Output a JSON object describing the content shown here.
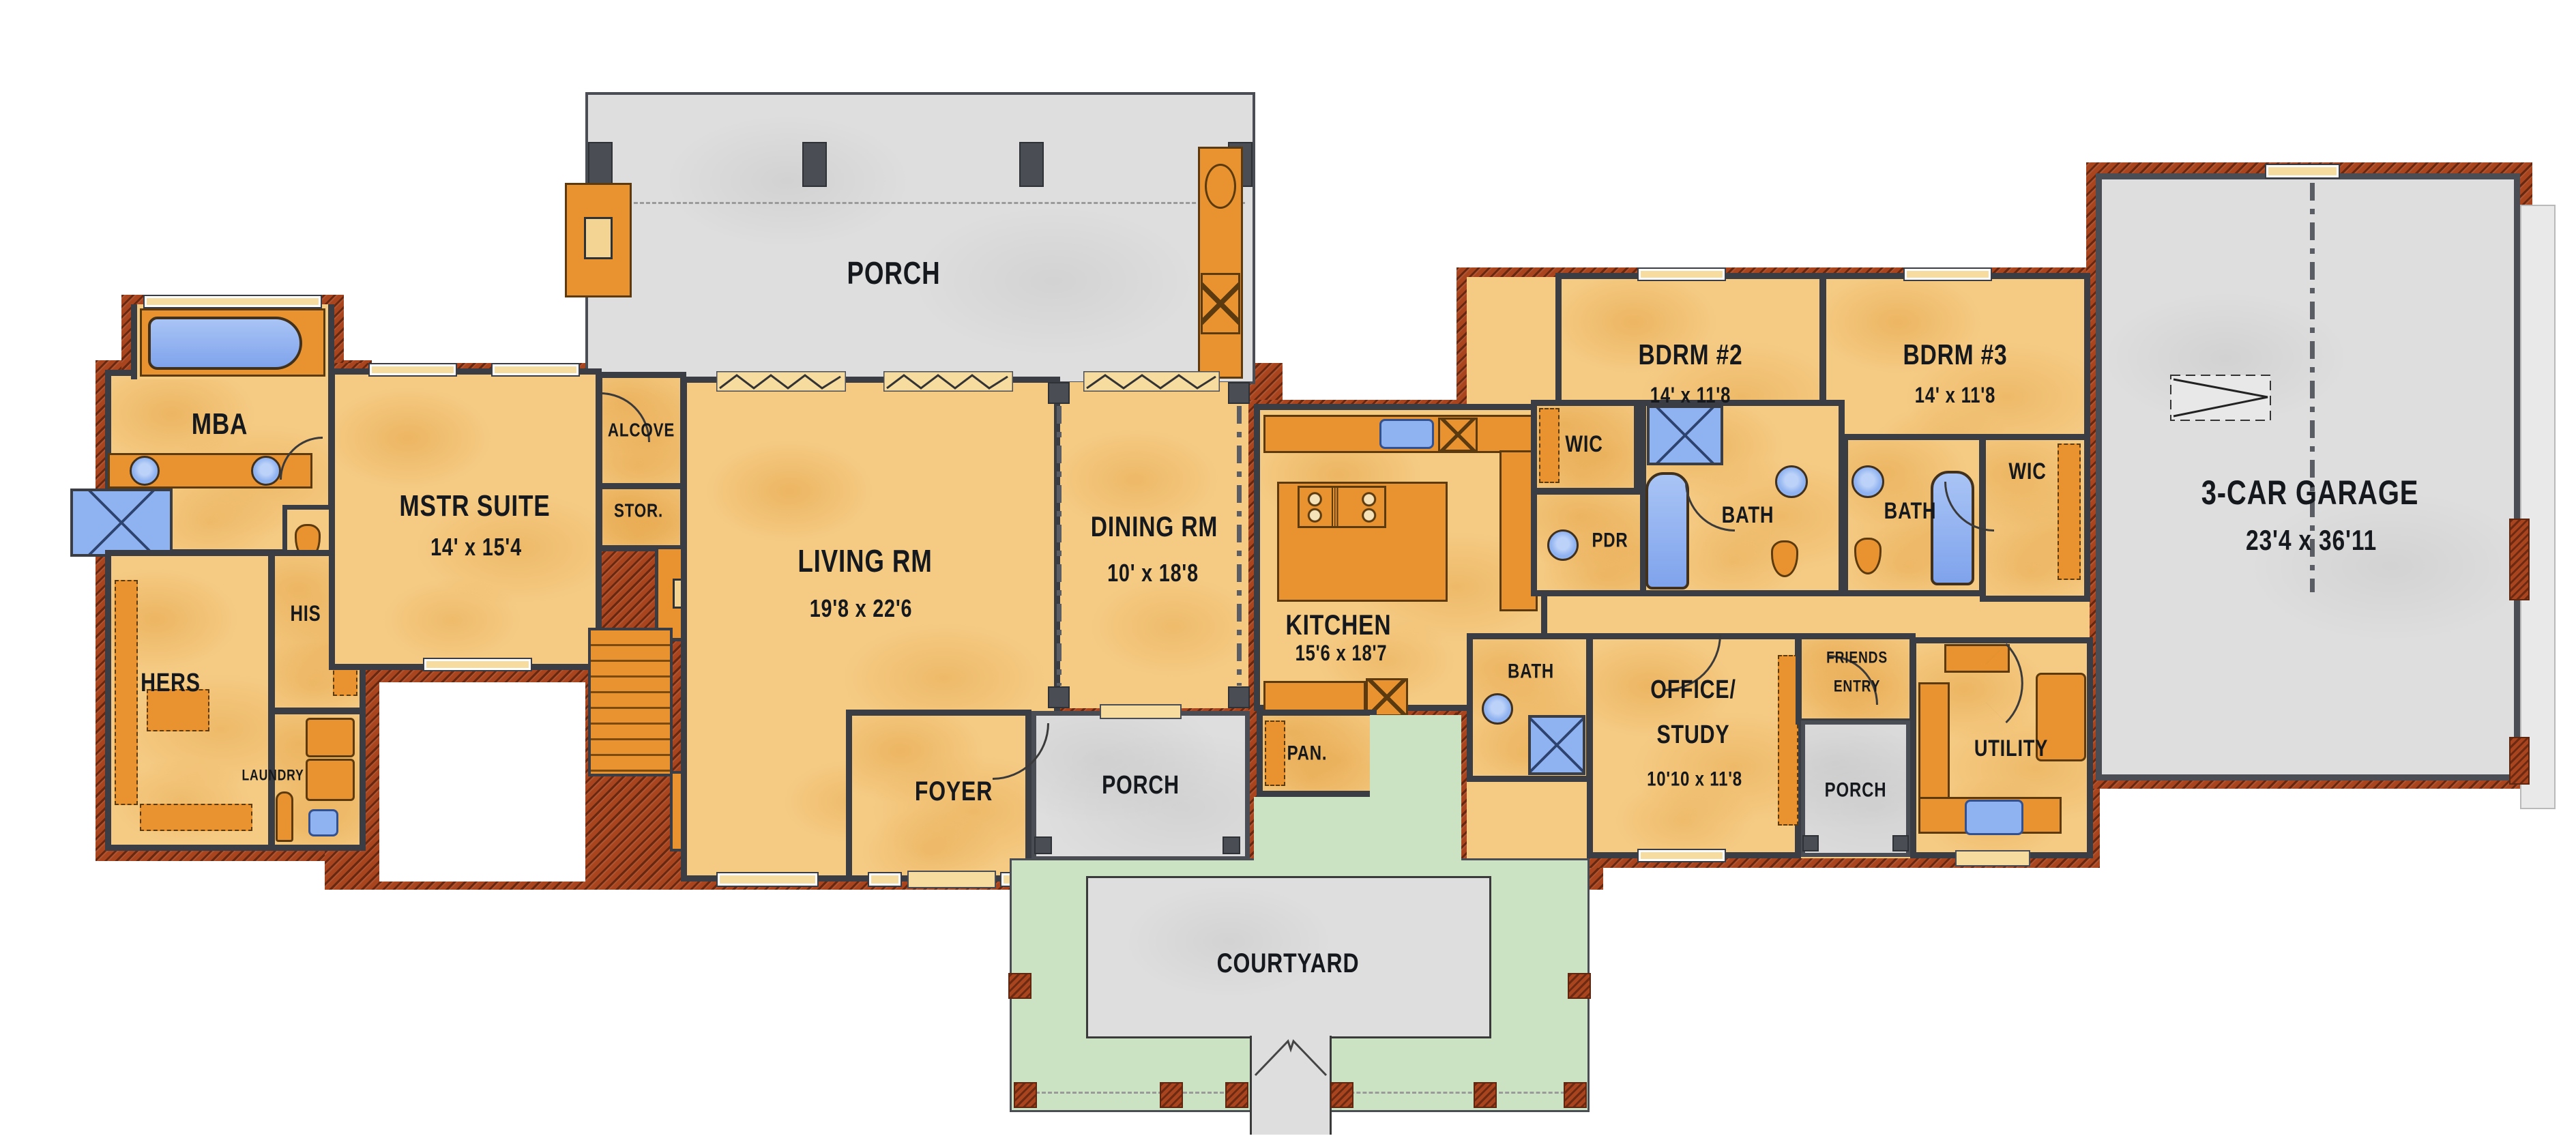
{
  "plan": {
    "rooms": {
      "porch_top": {
        "label": "PORCH"
      },
      "mba": {
        "label": "MBA"
      },
      "mstr_suite": {
        "label": "MSTR SUITE",
        "dims": "14' x 15'4"
      },
      "alcove": {
        "label": "ALCOVE"
      },
      "stor": {
        "label": "STOR."
      },
      "living": {
        "label": "LIVING RM",
        "dims": "19'8 x 22'6"
      },
      "dining": {
        "label": "DINING RM",
        "dims": "10' x 18'8"
      },
      "kitchen": {
        "label": "KITCHEN",
        "dims": "15'6 x 18'7"
      },
      "pan": {
        "label": "PAN."
      },
      "foyer": {
        "label": "FOYER"
      },
      "porch_center": {
        "label": "PORCH"
      },
      "courtyard": {
        "label": "COURTYARD"
      },
      "hers": {
        "label": "HERS"
      },
      "his": {
        "label": "HIS"
      },
      "laundry": {
        "label": "LAUNDRY"
      },
      "wic_left": {
        "label": "WIC"
      },
      "pdr": {
        "label": "PDR"
      },
      "bath2": {
        "label": "BATH"
      },
      "bath3": {
        "label": "BATH"
      },
      "wic_right": {
        "label": "WIC"
      },
      "bdrm2": {
        "label": "BDRM #2",
        "dims": "14' x 11'8"
      },
      "bdrm3": {
        "label": "BDRM #3",
        "dims": "14' x 11'8"
      },
      "bath_office": {
        "label": "BATH"
      },
      "office": {
        "label_line1": "OFFICE/",
        "label_line2": "STUDY",
        "dims": "10'10 x 11'8"
      },
      "friends_entry": {
        "label_line1": "FRIENDS",
        "label_line2": "ENTRY"
      },
      "porch_right": {
        "label": "PORCH"
      },
      "utility": {
        "label": "UTILITY"
      },
      "garage": {
        "label": "3-CAR GARAGE",
        "dims": "23'4 x 36'11"
      }
    },
    "colors": {
      "floor_tan": "#F5CB84",
      "floor_shade": "#E8AC55",
      "cabinet_orange": "#E89330",
      "wall_dark": "#3A3E44",
      "brick_red": "#A8451F",
      "porch_gray": "#DEDEDE",
      "courtyard_green": "#CBE3C3",
      "fixture_blue": "#8FB2F0",
      "label_ink": "#15181C"
    }
  }
}
